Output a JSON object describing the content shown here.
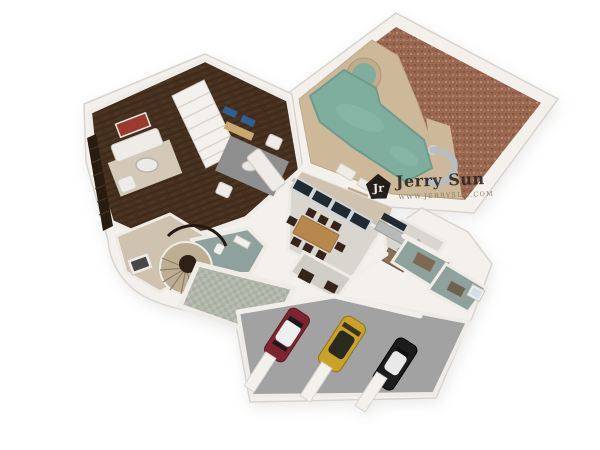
{
  "watermark": {
    "logo_monogram": "Jr",
    "brand": "Jerry Sun",
    "website": "WWW.JERRYSUN.COM"
  },
  "colors": {
    "wall": "#f4f1ed",
    "wall_edge": "#d9d4ce",
    "wood_floor": "#46301f",
    "gravel": "#9a6750",
    "deck": "#cdb999",
    "deck_dark": "#c0ab8a",
    "pool_water": "#7fae9e",
    "tile_floor": "#d9d5cf",
    "carpet": "#cfc2ae",
    "checker_a": "#b7bdb0",
    "checker_b": "#a9afa2",
    "bath_floor": "#8fa19c",
    "garage_floor": "#a2a2a2",
    "car_red": "#7e2430",
    "car_yellow": "#c9a227",
    "car_black": "#1c1c1c",
    "rug_gray": "#8f8f8f",
    "rug_beige": "#d3c9b6",
    "dining_table_wood": "#b8874b",
    "window_glass": "#202a33",
    "furniture_white": "#efece8",
    "art_red": "#9c3a30",
    "art_blue": "#2f5f96",
    "logo_black": "#16120e"
  }
}
